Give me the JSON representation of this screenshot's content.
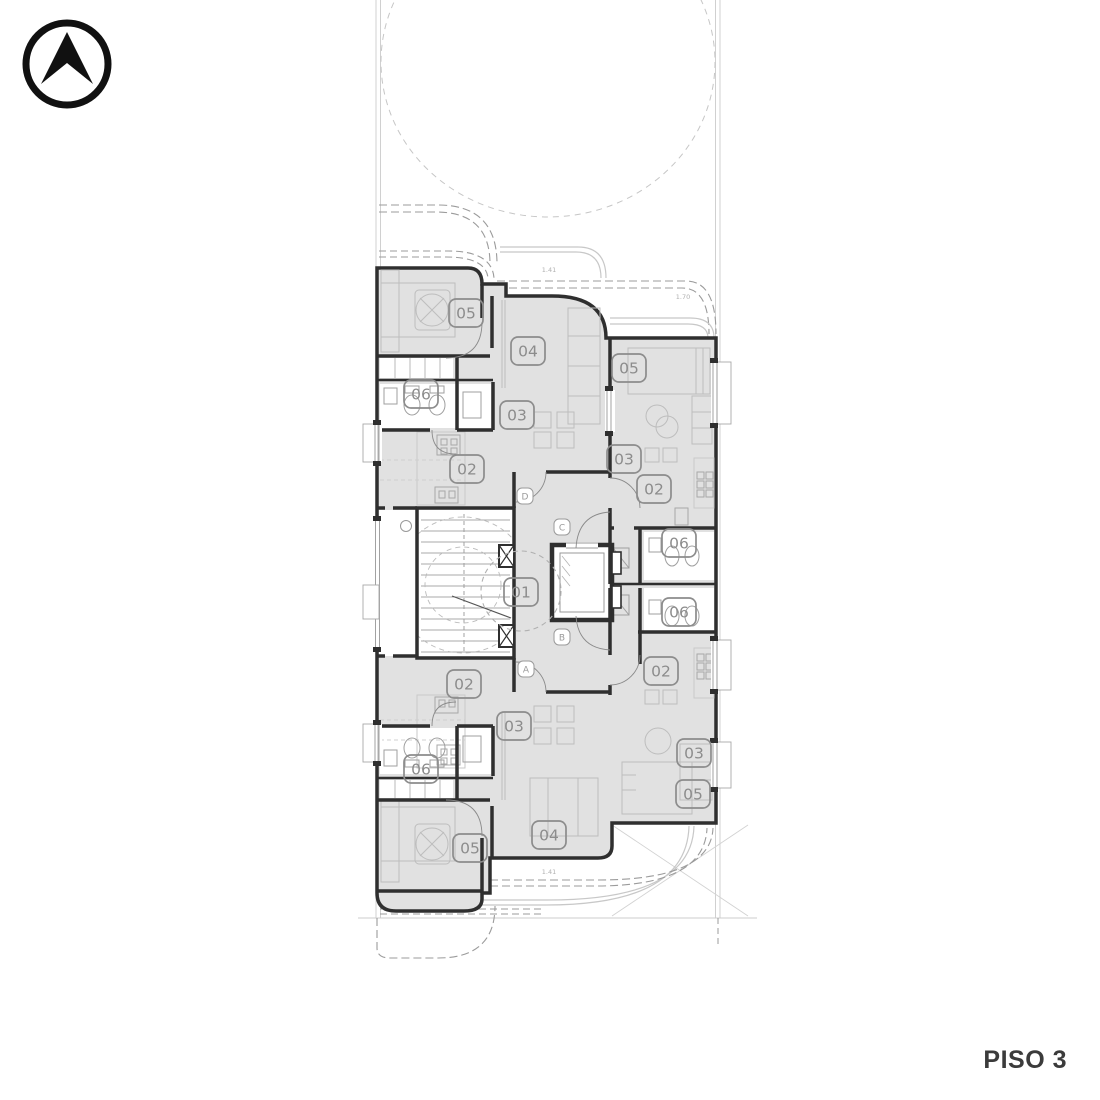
{
  "title_block": {
    "label": "PISO 3"
  },
  "north_arrow": {
    "icon": "north-arrow"
  },
  "colors": {
    "room_fill": "#e1e1e1",
    "wall": "#2f2f2f",
    "badge": "#8c8c8c",
    "furniture": "#bdbdbd",
    "dashed_outline": "#9b9b9b",
    "site_line": "#cccccc",
    "door_tag": "#9a9a9a",
    "dimension_text": "#b0b0b0",
    "title": "#3b3b3b"
  },
  "floor_plan": {
    "room_badges": [
      {
        "label": "05",
        "x": 466,
        "y": 313
      },
      {
        "label": "04",
        "x": 528,
        "y": 351
      },
      {
        "label": "06",
        "x": 421,
        "y": 394
      },
      {
        "label": "03",
        "x": 517,
        "y": 415
      },
      {
        "label": "02",
        "x": 467,
        "y": 469
      },
      {
        "label": "05",
        "x": 629,
        "y": 368
      },
      {
        "label": "03",
        "x": 624,
        "y": 459
      },
      {
        "label": "02",
        "x": 654,
        "y": 489
      },
      {
        "label": "06",
        "x": 679,
        "y": 543
      },
      {
        "label": "01",
        "x": 521,
        "y": 592
      },
      {
        "label": "06",
        "x": 679,
        "y": 612
      },
      {
        "label": "02",
        "x": 661,
        "y": 671
      },
      {
        "label": "02",
        "x": 464,
        "y": 684
      },
      {
        "label": "03",
        "x": 514,
        "y": 726
      },
      {
        "label": "06",
        "x": 421,
        "y": 769
      },
      {
        "label": "03",
        "x": 694,
        "y": 753
      },
      {
        "label": "05",
        "x": 693,
        "y": 794
      },
      {
        "label": "04",
        "x": 549,
        "y": 835
      },
      {
        "label": "05",
        "x": 470,
        "y": 848
      }
    ],
    "door_tags": [
      {
        "label": "D",
        "x": 525,
        "y": 496
      },
      {
        "label": "C",
        "x": 562,
        "y": 527
      },
      {
        "label": "B",
        "x": 562,
        "y": 637
      },
      {
        "label": "A",
        "x": 526,
        "y": 669
      }
    ],
    "dimension_labels": [
      {
        "text": "1.41",
        "x": 549,
        "y": 272
      },
      {
        "text": "1.70",
        "x": 683,
        "y": 299
      },
      {
        "text": "1.41",
        "x": 549,
        "y": 874
      }
    ]
  }
}
